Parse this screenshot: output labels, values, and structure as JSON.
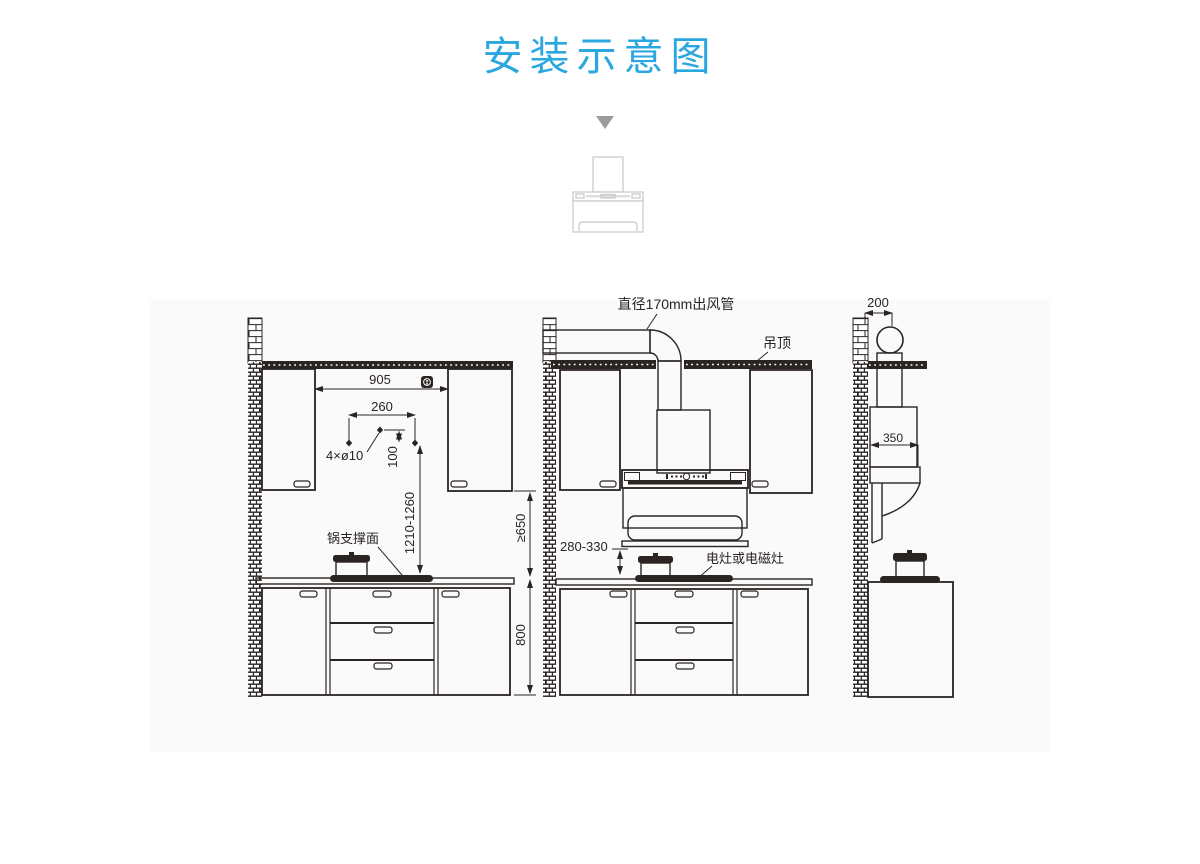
{
  "page": {
    "title": "安装示意图"
  },
  "colors": {
    "accent": "#2BA7E0",
    "line": "#2A2422",
    "panel_bg": "#FAFAFA",
    "sketch_gray": "#C8C8C8",
    "arrow_gray": "#9C9C9C"
  },
  "icons": {
    "down_arrow": "▼",
    "power_outlet": "wall-socket"
  },
  "front_view": {
    "dim_cabinet_gap": "905",
    "dim_hole_spacing": "260",
    "holes_label": "4×ø10",
    "dim_hole_offset": "100",
    "dim_install_height": "1210-1260",
    "pot_surface_label": "锅支撑面",
    "dim_min_clearance": "≥650",
    "dim_counter_height": "800"
  },
  "installed_view": {
    "duct_label": "直径170mm出风管",
    "ceiling_label": "吊顶",
    "dim_hood_clearance": "280-330",
    "stove_label": "电灶或电磁灶"
  },
  "side_view": {
    "dim_wall_offset": "200",
    "dim_hood_depth": "350"
  }
}
